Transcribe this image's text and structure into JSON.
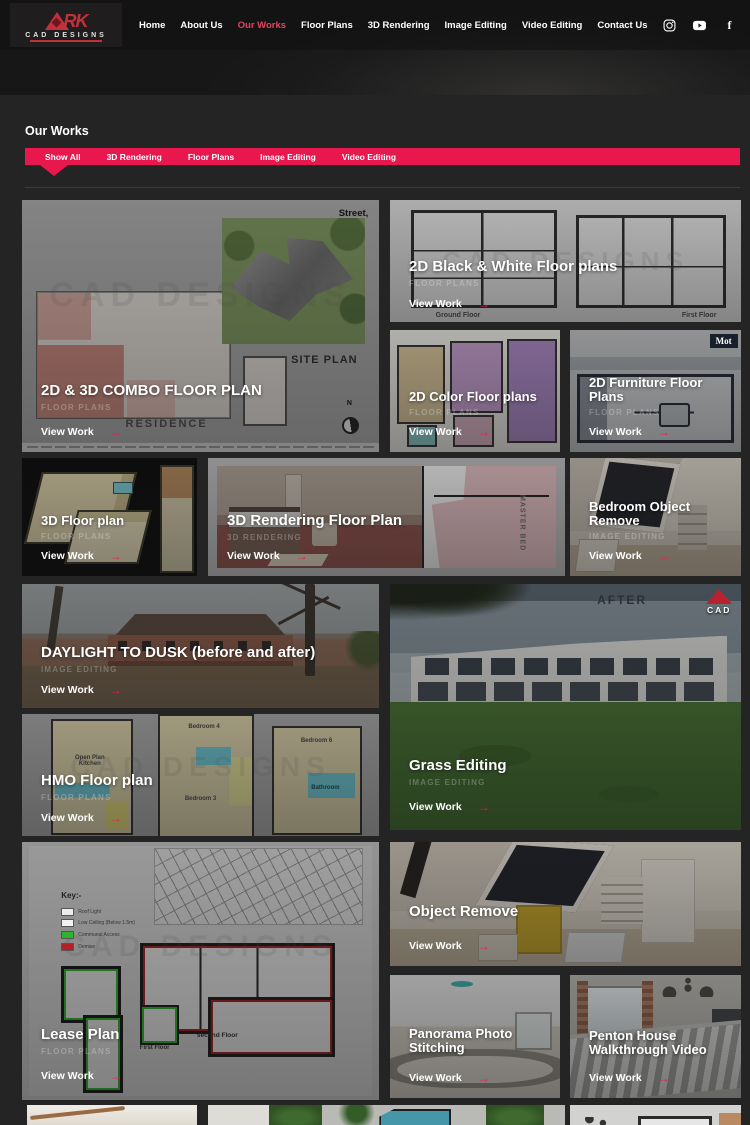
{
  "accent": "#e8174d",
  "header": {
    "logo": {
      "letters": "RK",
      "name": "CAD DESIGNS"
    },
    "nav": [
      {
        "label": "Home",
        "active": false
      },
      {
        "label": "About Us",
        "active": false
      },
      {
        "label": "Our Works",
        "active": true
      },
      {
        "label": "Floor Plans",
        "active": false
      },
      {
        "label": "3D Rendering",
        "active": false
      },
      {
        "label": "Image Editing",
        "active": false
      },
      {
        "label": "Video Editing",
        "active": false
      },
      {
        "label": "Contact Us",
        "active": false
      }
    ],
    "social": [
      "instagram",
      "youtube",
      "facebook"
    ]
  },
  "works": {
    "title": "Our Works",
    "filters": [
      {
        "label": "Show All",
        "active": true
      },
      {
        "label": "3D Rendering",
        "active": false
      },
      {
        "label": "Floor Plans",
        "active": false
      },
      {
        "label": "Image Editing",
        "active": false
      },
      {
        "label": "Video Editing",
        "active": false
      }
    ],
    "view_work": "View Work",
    "view_arrow": "→",
    "watermark": "CAD DESIGNS",
    "cards": [
      {
        "title": "2D & 3D COMBO FLOOR PLAN",
        "subtitle": "FLOOR PLANS",
        "captions": {
          "street": "Street,",
          "site_plan": "SITE PLAN",
          "residence": "RESIDENCE",
          "north": "N"
        }
      },
      {
        "title": "2D Black & White Floor plans",
        "subtitle": "FLOOR PLANS",
        "captions": {
          "ground": "Ground Floor",
          "first": "First Floor"
        }
      },
      {
        "title": "2D Color Floor plans",
        "subtitle": "FLOOR PLANS"
      },
      {
        "title": "2D Furniture Floor Plans",
        "subtitle": "FLOOR PLANS",
        "captions": {
          "logo": "Mot"
        }
      },
      {
        "title": "3D Floor plan",
        "subtitle": "FLOOR PLANS"
      },
      {
        "title": "3D Rendering Floor Plan",
        "subtitle": "3D RENDERING",
        "captions": {
          "master": "MASTER BED"
        }
      },
      {
        "title": "Bedroom Object Remove",
        "subtitle": "IMAGE EDITING"
      },
      {
        "title": "DAYLIGHT TO DUSK (before and after)",
        "subtitle": "IMAGE EDITING"
      },
      {
        "title": "Grass Editing",
        "subtitle": "IMAGE EDITING",
        "captions": {
          "after": "AFTER",
          "logo": "CAD"
        }
      },
      {
        "title": "HMO Floor plan",
        "subtitle": "FLOOR PLANS",
        "captions": {
          "kitchen": "Open Plan\nKitchen",
          "bed4": "Bedroom 4",
          "bed3": "Bedroom 3",
          "bed6": "Bedroom 6",
          "bath": "Bathroom"
        }
      },
      {
        "title": "Lease Plan",
        "subtitle": "FLOOR PLANS",
        "captions": {
          "key": "Key:-",
          "item1": "Roof Light",
          "item2": "Low Ceiling (Below 1.5m)",
          "item3": "Communal Access",
          "item4": "Demise",
          "first": "First Floor",
          "second": "second Floor"
        }
      },
      {
        "title": "Object Remove",
        "subtitle": ""
      },
      {
        "title": "Panorama Photo Stitching",
        "subtitle": ""
      },
      {
        "title": "Penton House Walkthrough Video",
        "subtitle": ""
      }
    ]
  }
}
